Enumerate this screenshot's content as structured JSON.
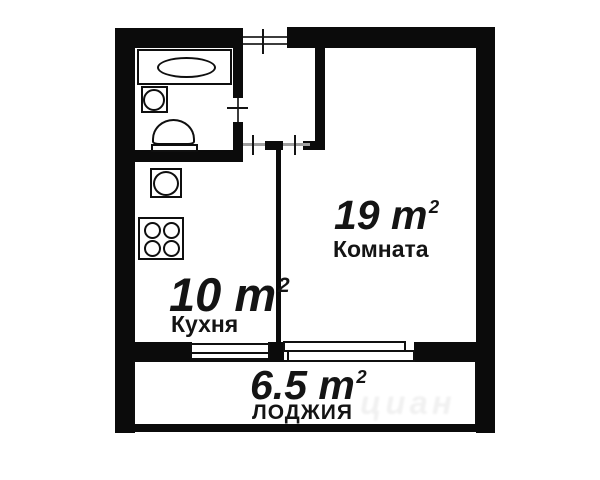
{
  "plan": {
    "colors": {
      "wall": "#0b0b0b",
      "background": "#ffffff",
      "door_line": "#a0a0a0",
      "text": "#141414"
    },
    "rooms": [
      {
        "area_value": "19 m",
        "area_sup": "2",
        "name": "Комната"
      },
      {
        "area_value": "10 m",
        "area_sup": "2",
        "name": "Кухня"
      },
      {
        "area_value": "6.5 m",
        "area_sup": "2",
        "name": "ЛОДЖИЯ"
      }
    ],
    "fixture_icons": [
      "bathtub-icon",
      "washbasin-icon",
      "toilet-icon",
      "kitchen-sink-icon",
      "stove-icon"
    ],
    "door_icons": [
      "entrance-door",
      "bathroom-door",
      "kitchen-door",
      "living-room-door"
    ],
    "window_icons": [
      "kitchen-window",
      "living-room-window"
    ],
    "watermark": "циан"
  }
}
